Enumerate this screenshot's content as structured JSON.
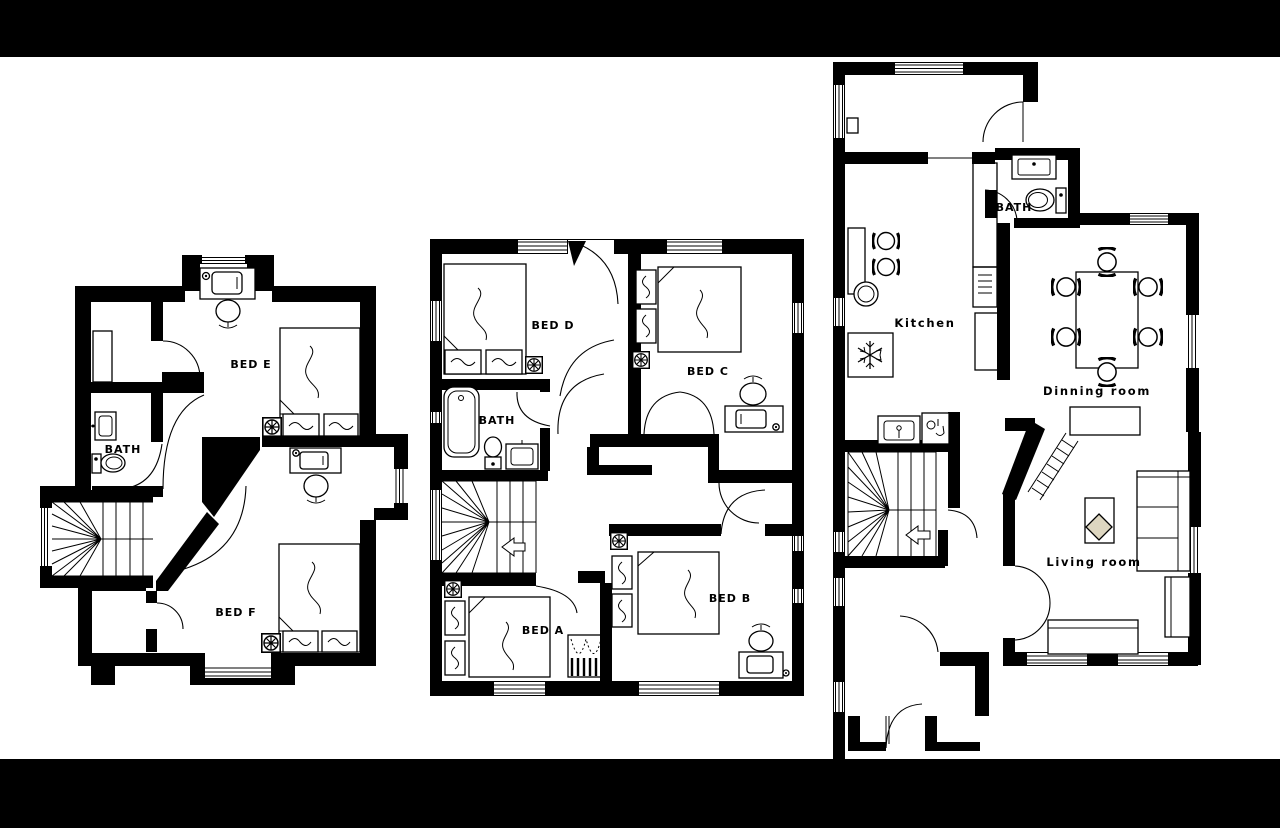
{
  "scene": {
    "type": "floor-plan-set",
    "background": "#ffffff",
    "letterbox_color": "#000000",
    "wall_color": "#000000",
    "rug_accent_color": "#ddd6c0"
  },
  "plans": {
    "left": {
      "labels": {
        "bed_e": "BED E",
        "bath": "BATH",
        "bed_f": "BED F"
      }
    },
    "middle": {
      "labels": {
        "bed_d": "BED D",
        "bed_c": "BED C",
        "bath": "BATH",
        "bed_a": "BED A",
        "bed_b": "BED B"
      }
    },
    "right": {
      "labels": {
        "bath": "BATH",
        "kitchen": "Kitchen",
        "dinning_room": "Dinning room",
        "living_room": "Living room"
      }
    }
  }
}
